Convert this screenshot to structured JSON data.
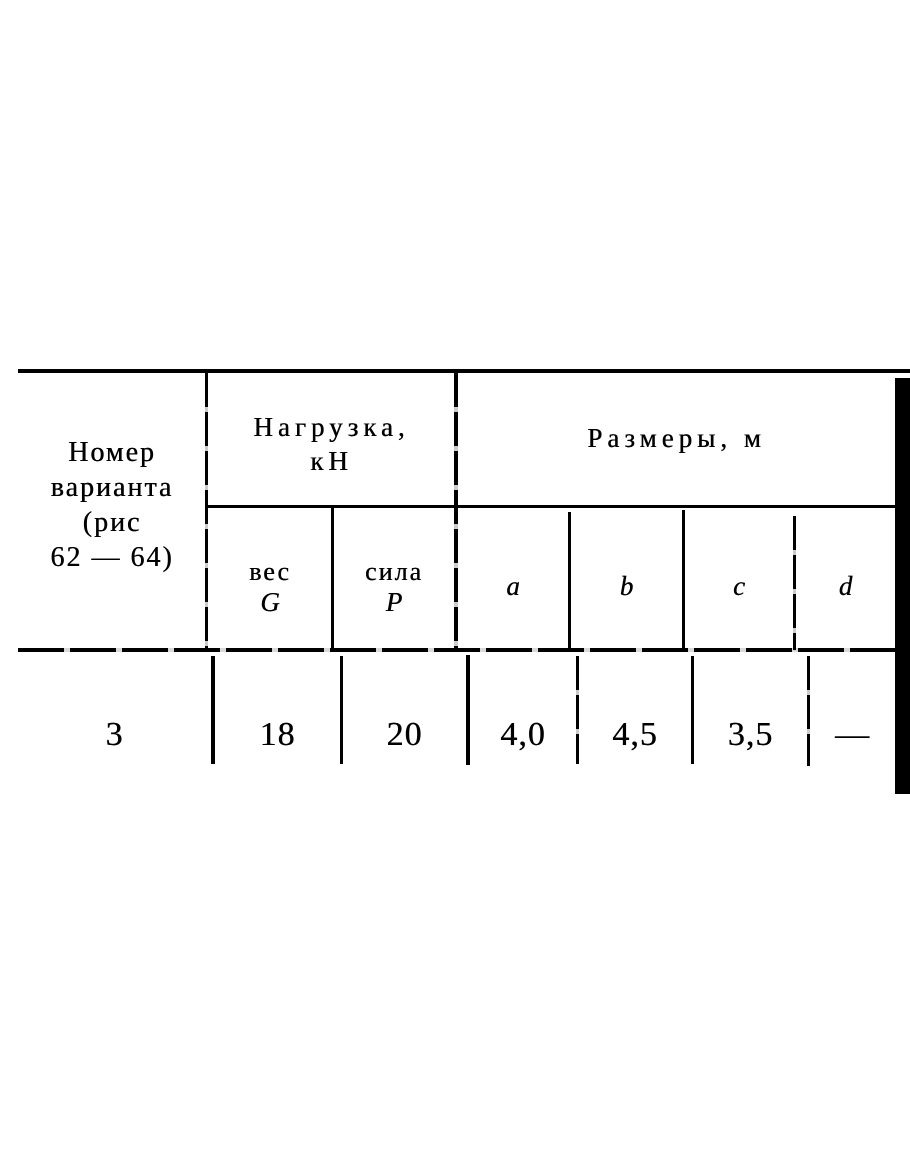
{
  "table": {
    "header": {
      "variant": {
        "line1": "Номер",
        "line2": "варианта",
        "line3": "(рис",
        "line4": "62 — 64)"
      },
      "load_group": {
        "title_line1": "Нагрузка,",
        "title_line2": "кН",
        "weight_label": "вес",
        "weight_symbol": "G",
        "force_label": "сила",
        "force_symbol": "Р"
      },
      "dims_group": {
        "title": "Размеры, м",
        "col_a": "a",
        "col_b": "b",
        "col_c": "c",
        "col_d": "d"
      }
    },
    "row": {
      "variant": "3",
      "weight_g": "18",
      "force_p": "20",
      "a": "4,0",
      "b": "4,5",
      "c": "3,5",
      "d": "—"
    }
  }
}
